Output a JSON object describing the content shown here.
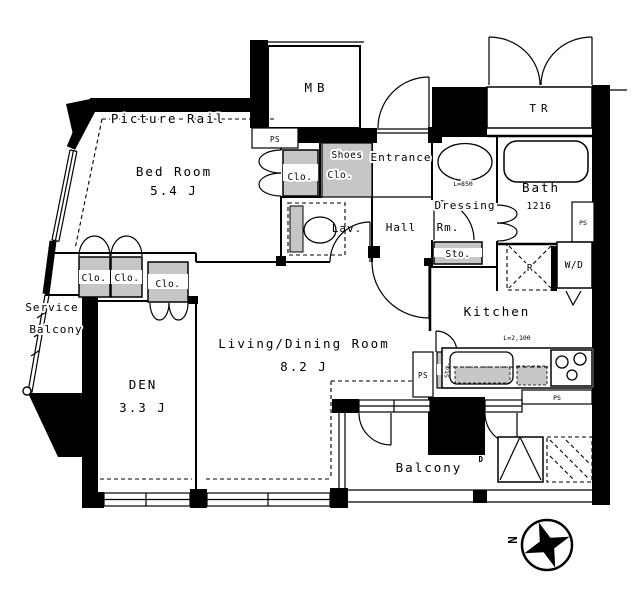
{
  "rooms": {
    "bedroom": {
      "label": "Bed Room",
      "size": "5.4 J"
    },
    "living_dining": {
      "label": "Living/Dining Room",
      "size": "8.2 J"
    },
    "den": {
      "label": "DEN",
      "size": "3.3 J"
    },
    "kitchen": {
      "label": "Kitchen"
    },
    "bath": {
      "label": "Bath",
      "size": "1216"
    },
    "dressing": {
      "line1": "Dressing",
      "line2": "Rm."
    },
    "hall": {
      "label": "Hall"
    },
    "lavatory": {
      "label": "Lav."
    },
    "entrance": {
      "label": "Entrance"
    },
    "balcony": {
      "label": "Balcony"
    },
    "service_balcony": {
      "line1": "Service",
      "line2": "Balcony"
    }
  },
  "closets": {
    "closet": "Clo.",
    "shoes": {
      "line1": "Shoes",
      "line2": "Clo."
    },
    "storage": "Sto."
  },
  "fixtures": {
    "meter_box": "MB",
    "trunk_room": "TR",
    "refrigerator": "R",
    "washer_dryer": "W/D",
    "pipe_space": "PS"
  },
  "dimensions": {
    "bath_size": "1216",
    "basin_length": "L=850",
    "counter_length": "L=2,100"
  },
  "annotations": {
    "picture_rail": "Picture Rail",
    "door_mark": "D",
    "north": "N"
  }
}
